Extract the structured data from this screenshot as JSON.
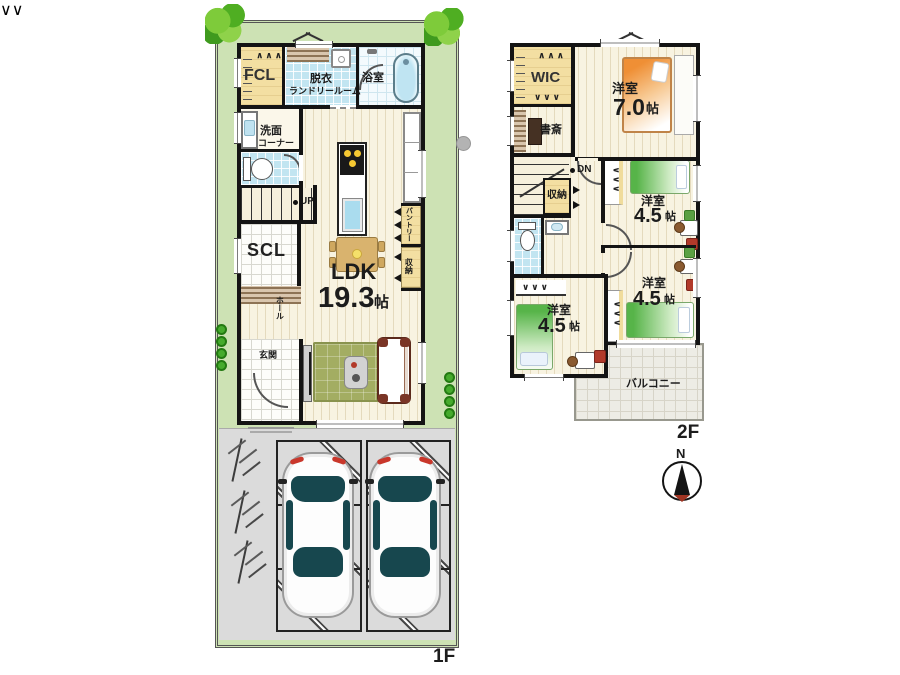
{
  "colors": {
    "plot_green": "#cde2b4",
    "floor_cream": "#f8f3e1",
    "tile_blue": "#c2e5f1",
    "closet_yellow": "#f3dfa2",
    "wall_black": "#141414",
    "rug_olive": "#a3ad62",
    "bed_orange": "#f0913a",
    "bed_green": "#57b449",
    "parking_gray": "#dbdbdb"
  },
  "f1": {
    "floor_label": "1F",
    "fcl": "FCL",
    "laundry_line1": "脱衣",
    "laundry_line2": "ランドリールーム",
    "bath": "浴室",
    "washroom_line1": "洗面",
    "washroom_line2": "コーナー",
    "stairs_up": "UP",
    "scl": "SCL",
    "hall": "ホール",
    "entrance": "玄関",
    "ldk_name": "LDK",
    "ldk_size": "19.3",
    "ldk_unit": "帖",
    "pantry": "パントリー",
    "storage": "収納"
  },
  "f2": {
    "floor_label": "2F",
    "wic": "WIC",
    "study": "書斎",
    "bedroom7_name": "洋室",
    "bedroom7_size": "7.0",
    "bedroom7_unit": "帖",
    "stairs_down": "DN",
    "storage": "収納",
    "bedroom45a_name": "洋室",
    "bedroom45a_size": "4.5",
    "bedroom45a_unit": "帖",
    "bedroom45b_name": "洋室",
    "bedroom45b_size": "4.5",
    "bedroom45b_unit": "帖",
    "bedroom45c_name": "洋室",
    "bedroom45c_size": "4.5",
    "bedroom45c_unit": "帖",
    "balcony": "バルコニー"
  },
  "compass": {
    "north": "N"
  }
}
